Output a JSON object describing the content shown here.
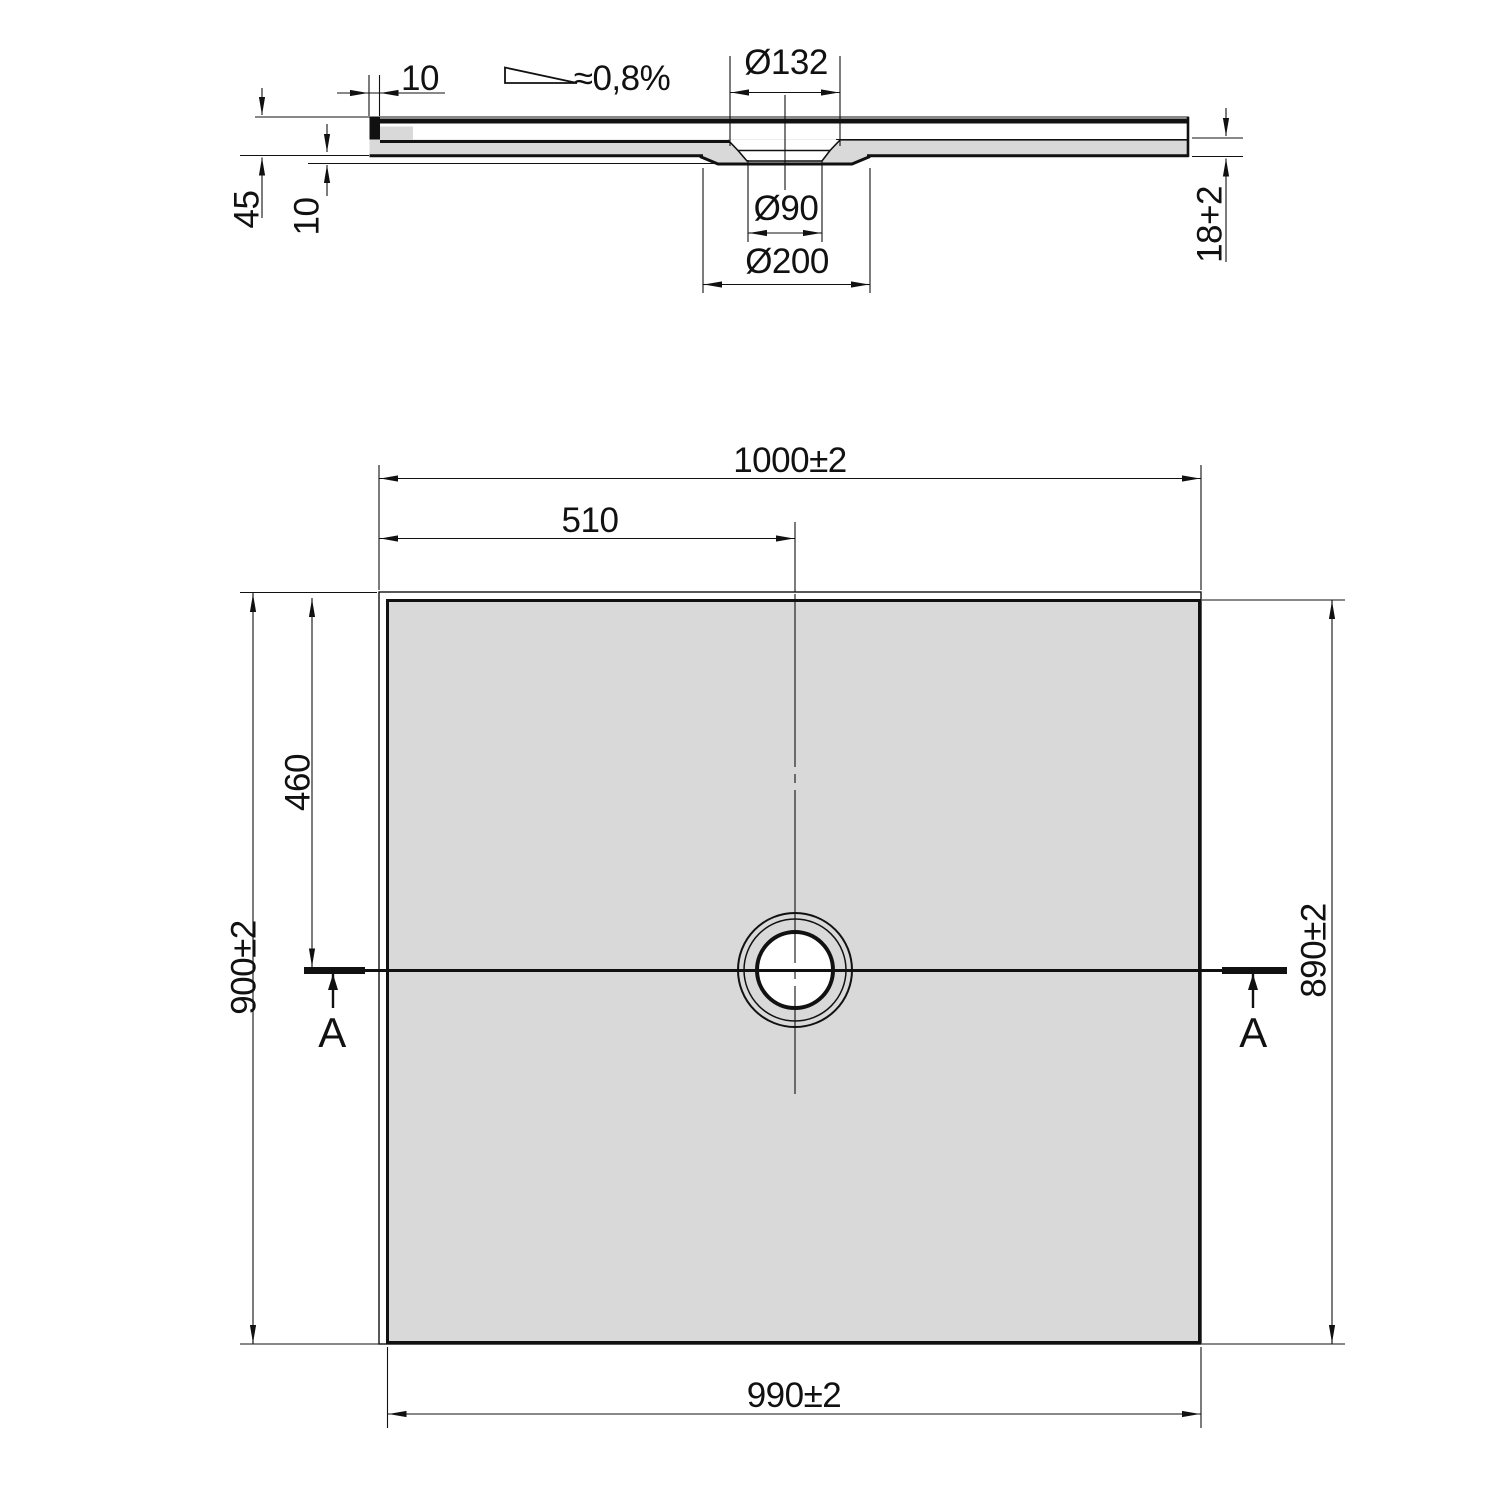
{
  "section_view": {
    "rim_width_label": "10",
    "slope_label": "≈0,8%",
    "flange_diameter_label": "Ø132",
    "hole_diameter_label": "Ø90",
    "pocket_diameter_label": "Ø200",
    "total_height_label": "45",
    "pocket_depth_label": "10",
    "edge_thickness_label": "18+2"
  },
  "plan_view": {
    "outer_width_label": "1000±2",
    "drain_offset_x_label": "510",
    "outer_depth_label": "900±2",
    "drain_offset_y_label": "460",
    "inner_depth_label": "890±2",
    "inner_width_label": "990±2",
    "section_marker_left": "A",
    "section_marker_right": "A"
  },
  "colors": {
    "line": "#111111",
    "surface_fill": "#d9d9d9",
    "background": "#ffffff"
  }
}
